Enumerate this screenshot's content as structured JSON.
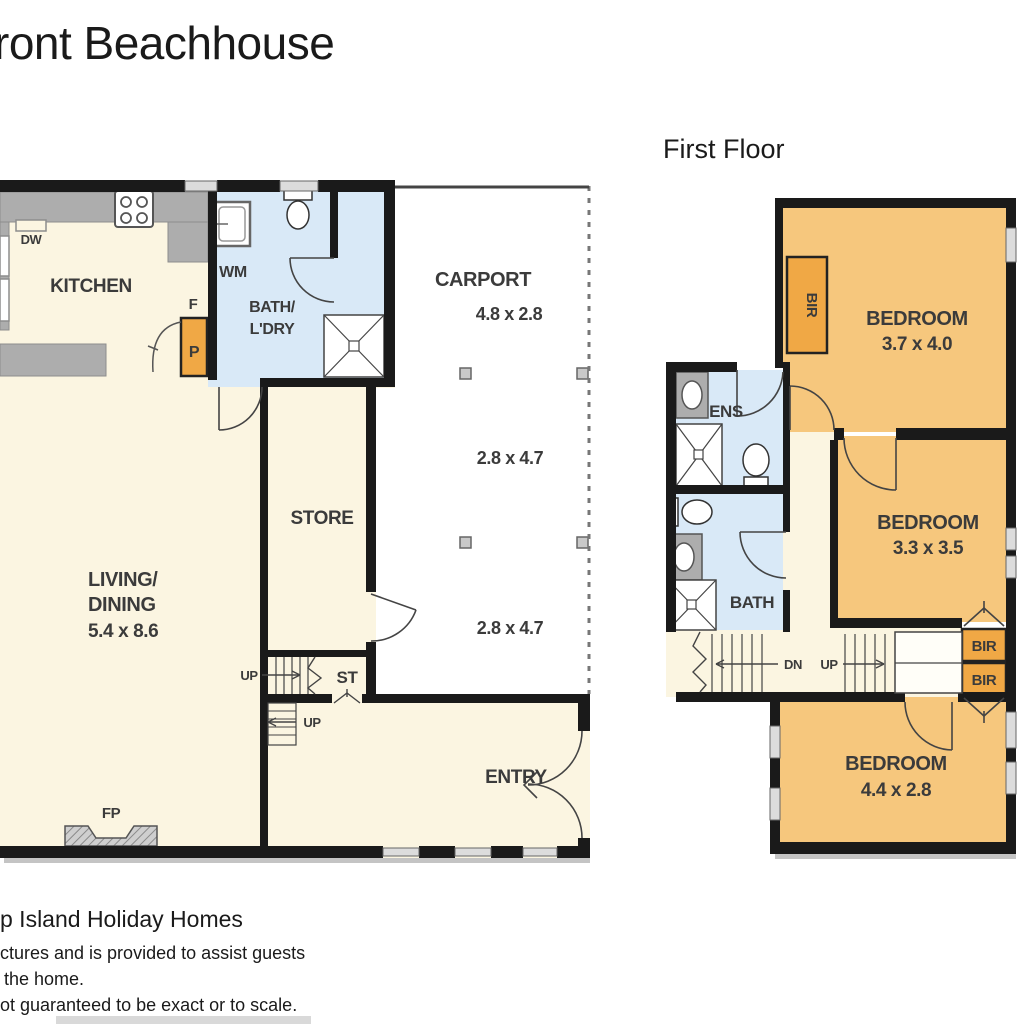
{
  "title": "ront Beachhouse",
  "ff_heading": "First Floor",
  "gf": {
    "kitchen": "KITCHEN",
    "dw": "DW",
    "wm": "WM",
    "f": "F",
    "p": "P",
    "bath1": "BATH/",
    "bath2": "L'DRY",
    "carport": "CARPORT",
    "carport_dim": "4.8 x 2.8",
    "dim1": "2.8 x 4.7",
    "dim2": "2.8 x 4.7",
    "store": "STORE",
    "living1": "LIVING/",
    "living2": "DINING",
    "living_dim": "5.4 x 8.6",
    "up1": "UP",
    "up2": "UP",
    "st": "ST",
    "entry": "ENTRY",
    "fp": "FP"
  },
  "ff": {
    "bed1": "BEDROOM",
    "bed1_dim": "3.7 x 4.0",
    "bed2": "BEDROOM",
    "bed2_dim": "3.3 x 3.5",
    "bed3": "BEDROOM",
    "bed3_dim": "4.4 x 2.8",
    "ens": "ENS",
    "bath": "BATH",
    "dn": "DN",
    "up": "UP",
    "bir1": "BIR",
    "bir2": "BIR",
    "bir3": "BIR"
  },
  "footer": {
    "line1": "p Island Holiday Homes",
    "line2": "ctures and is provided to assist guests",
    "line3": "the home.",
    "line4": "ot guaranteed to be exact or to scale."
  },
  "colors": {
    "floor_cream": "#FBF5E1",
    "room_orange": "#F6C77D",
    "accent_orange": "#F0A845",
    "bath_blue": "#D9E9F7",
    "counter_gray": "#ADADAD",
    "wall_black": "#1A1A1A"
  }
}
